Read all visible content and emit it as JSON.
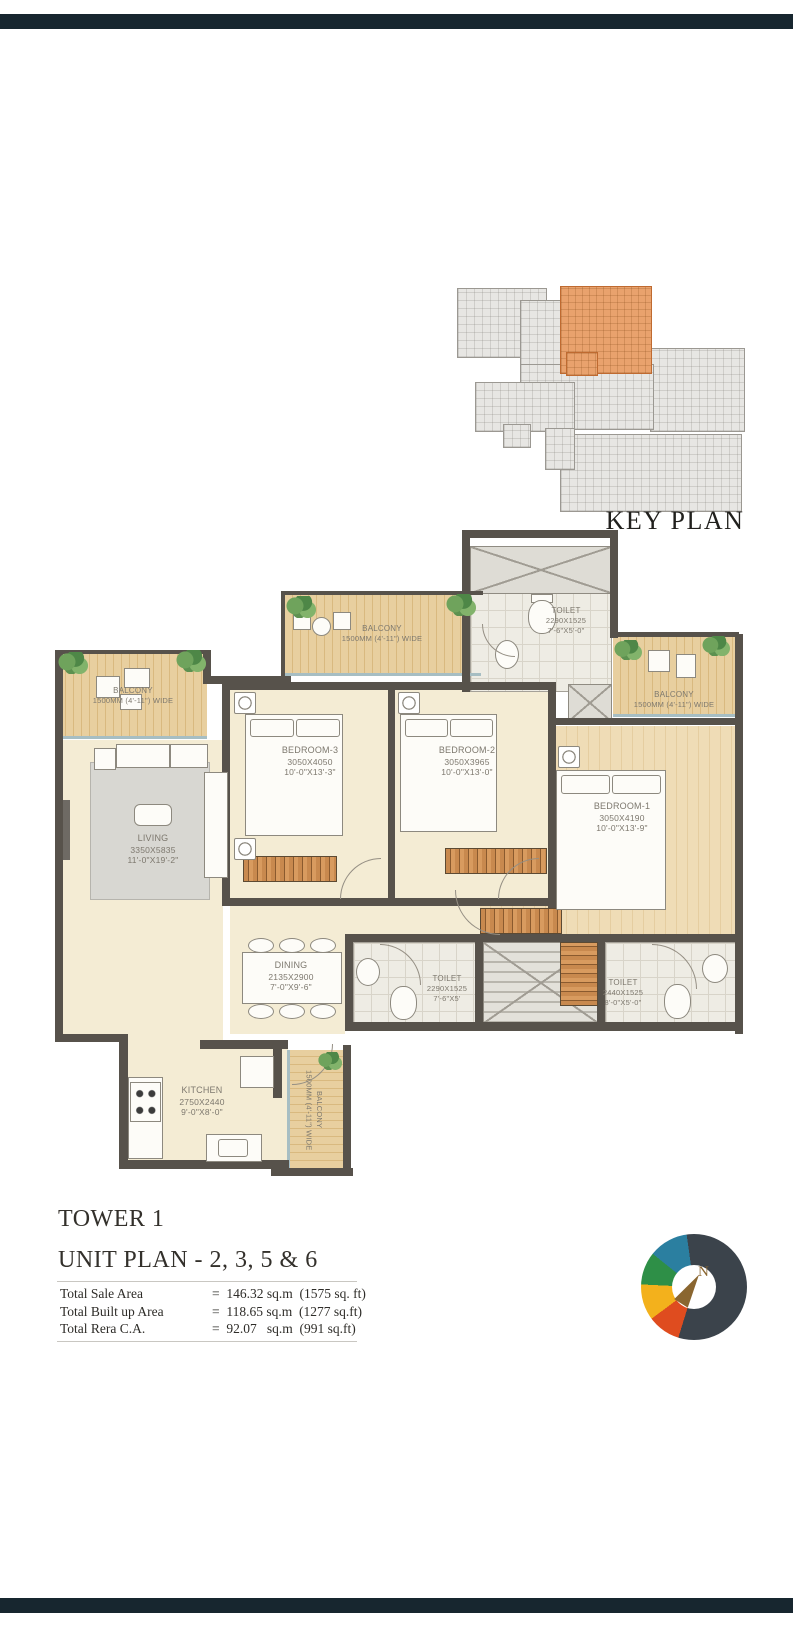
{
  "key_plan": {
    "label": "KEY PLAN"
  },
  "plan": {
    "rooms": {
      "balcony_left": {
        "name": "BALCONY",
        "size": "1500MM (4'-11\") WIDE"
      },
      "balcony_top": {
        "name": "BALCONY",
        "size": "1500MM (4'-11\") WIDE"
      },
      "balcony_right": {
        "name": "BALCONY",
        "size": "1500MM (4'-11\") WIDE"
      },
      "balcony_bottom": {
        "name": "BALCONY",
        "size": "1500MM (4'-11\") WIDE"
      },
      "bedroom1": {
        "name": "BEDROOM-1",
        "mm": "3050X4190",
        "ft": "10'-0\"X13'-9\""
      },
      "bedroom2": {
        "name": "BEDROOM-2",
        "mm": "3050X3965",
        "ft": "10'-0\"X13'-0\""
      },
      "bedroom3": {
        "name": "BEDROOM-3",
        "mm": "3050X4050",
        "ft": "10'-0\"X13'-3\""
      },
      "living": {
        "name": "LIVING",
        "mm": "3350X5835",
        "ft": "11'-0\"X19'-2\""
      },
      "dining": {
        "name": "DINING",
        "mm": "2135X2900",
        "ft": "7'-0\"X9'-6\""
      },
      "kitchen": {
        "name": "KITCHEN",
        "mm": "2750X2440",
        "ft": "9'-0\"X8'-0\""
      },
      "toilet_top": {
        "name": "TOILET",
        "mm": "2290X1525",
        "ft": "7'-6\"X5'-0\""
      },
      "toilet_mid": {
        "name": "TOILET",
        "mm": "2290X1525",
        "ft": "7'-6\"X5'"
      },
      "toilet_right": {
        "name": "TOILET",
        "mm": "2440X1525",
        "ft": "8'-0\"X5'-0\""
      }
    }
  },
  "footer": {
    "tower": "TOWER 1",
    "unit_plan": "UNIT PLAN - 2, 3, 5 & 6",
    "areas": [
      {
        "label": "Total Sale Area",
        "value": "=  146.32 sq.m  (1575 sq. ft)"
      },
      {
        "label": "Total Built up Area",
        "value": "=  118.65 sq.m  (1277 sq.ft)"
      },
      {
        "label": "Total Rera C.A.",
        "value": "=  92.07   sq.m  (991 sq.ft)"
      }
    ],
    "logo_letter": "N"
  },
  "colors": {
    "highlight_unit": "#e9a26d",
    "wall": "#57524b",
    "logo_ring": [
      "#3b434b",
      "#df4c1f",
      "#f3b11c",
      "#2e8f47",
      "#2b7fa0"
    ],
    "logo_gold": "#8a6630",
    "bar": "#17262f"
  }
}
